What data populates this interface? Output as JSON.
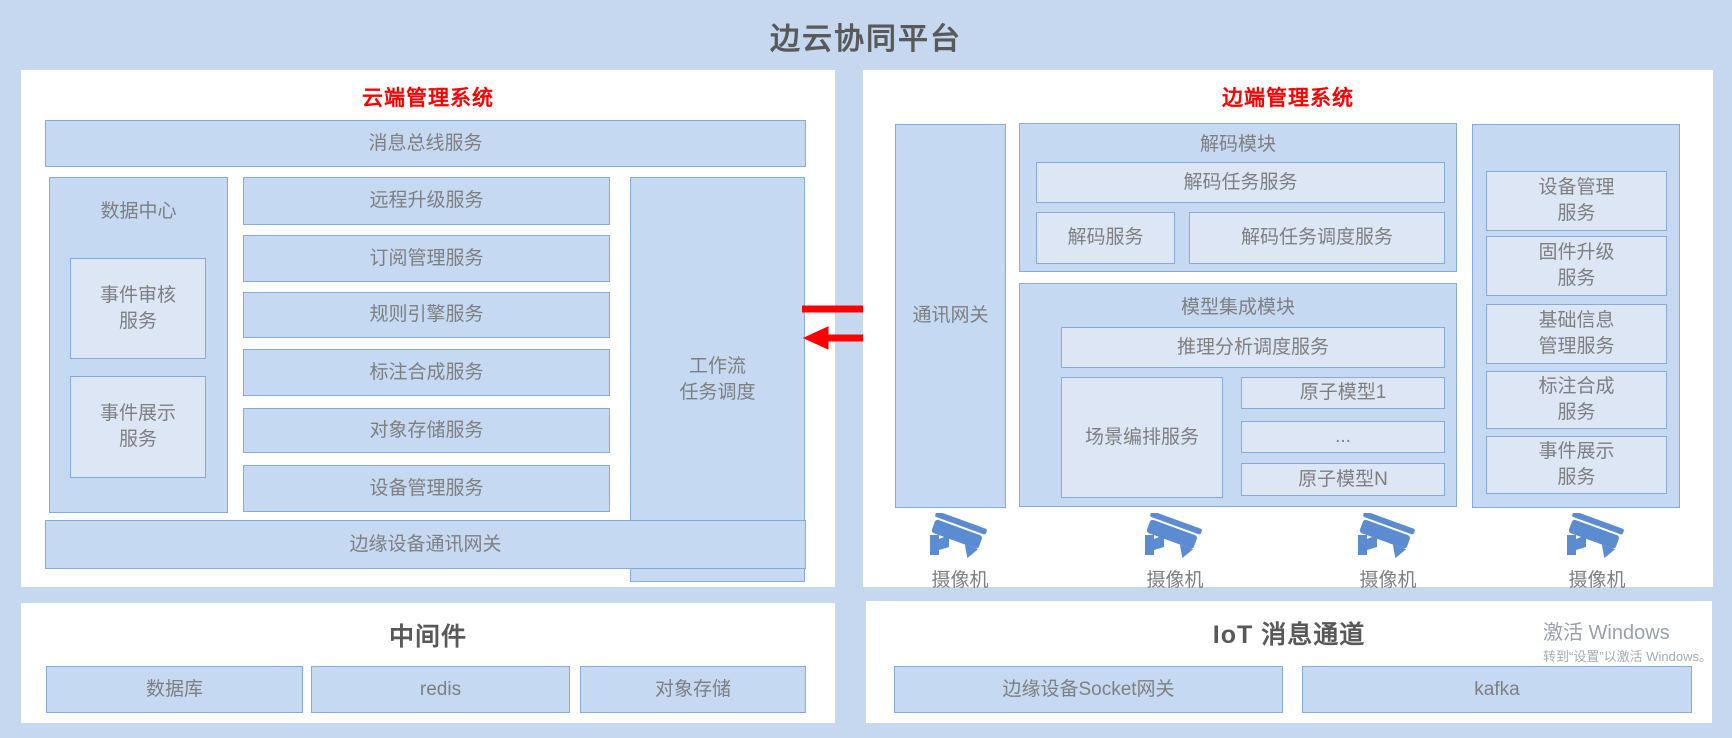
{
  "page": {
    "title": "边云协同平台"
  },
  "cloud": {
    "title": "云端管理系统",
    "bus": "消息总线服务",
    "data_center": {
      "title": "数据中心",
      "items": [
        "事件审核\n服务",
        "事件展示\n服务"
      ]
    },
    "services": [
      "远程升级服务",
      "订阅管理服务",
      "规则引擎服务",
      "标注合成服务",
      "对象存储服务",
      "设备管理服务"
    ],
    "workflow": "工作流\n任务调度",
    "gateway": "边缘设备通讯网关"
  },
  "edge": {
    "title": "边端管理系统",
    "comm_gateway": "通讯网关",
    "decode": {
      "title": "解码模块",
      "task": "解码任务服务",
      "service": "解码服务",
      "scheduler": "解码任务调度服务"
    },
    "model": {
      "title": "模型集成模块",
      "inference": "推理分析调度服务",
      "scene": "场景编排服务",
      "atoms": [
        "原子模型1",
        "...",
        "原子模型N"
      ]
    },
    "device_services": [
      "设备管理\n服务",
      "固件升级\n服务",
      "基础信息\n管理服务",
      "标注合成\n服务",
      "事件展示\n服务"
    ],
    "cameras": [
      "摄像机",
      "摄像机",
      "摄像机",
      "摄像机"
    ]
  },
  "middleware": {
    "title": "中间件",
    "items": [
      "数据库",
      "redis",
      "对象存储"
    ]
  },
  "iot": {
    "title": "IoT 消息通道",
    "items": [
      "边缘设备Socket网关",
      "kafka"
    ]
  },
  "watermark": {
    "line1": "激活 Windows",
    "line2": "转到“设置”以激活 Windows。"
  },
  "colors": {
    "accent_red": "#ff0000",
    "camera_blue": "#5b8bd0",
    "box_fill": "#c5d9f2",
    "box_fill_light": "#dde6f5",
    "border": "#85aadb"
  }
}
